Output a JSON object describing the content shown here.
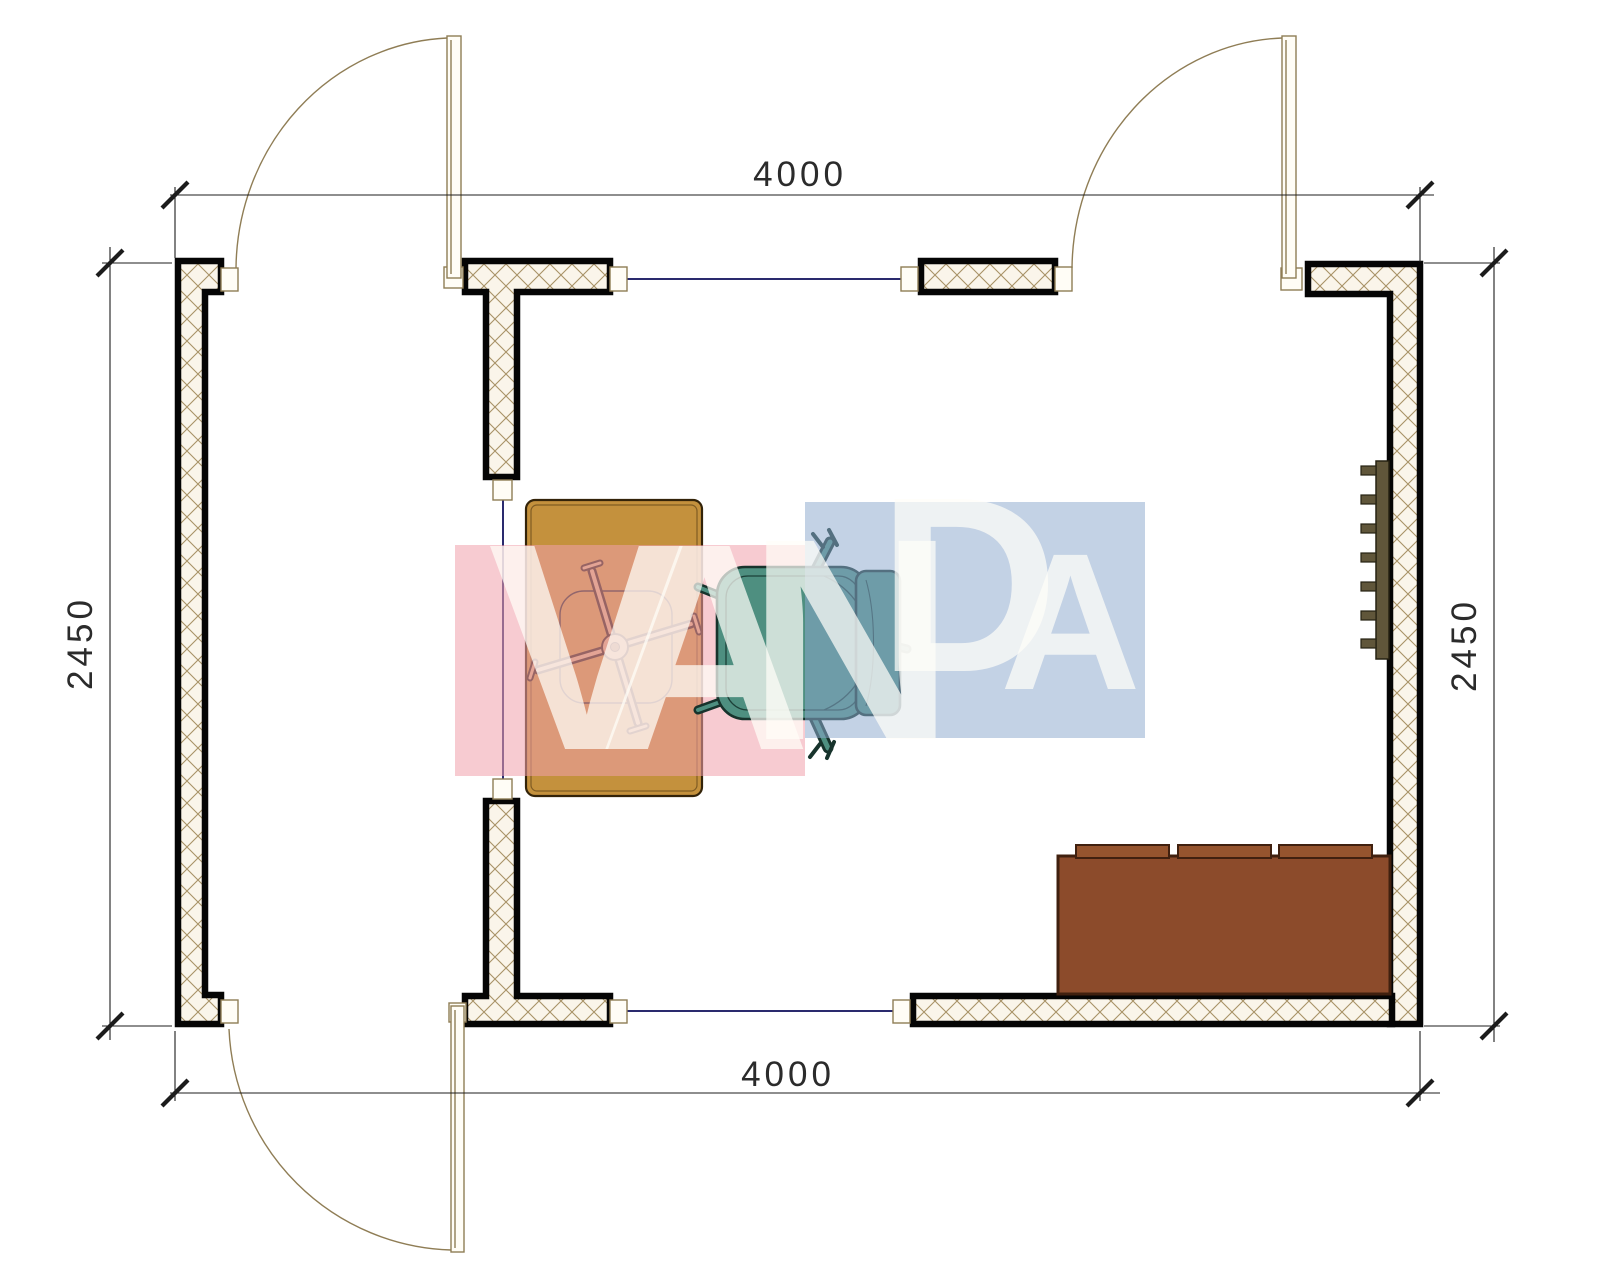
{
  "drawing": {
    "type": "floor-plan",
    "title": "room plan 4000 x 2450"
  },
  "dimensions": {
    "top": "4000",
    "bottom": "4000",
    "left": "2450",
    "right": "2450"
  },
  "watermark": {
    "text": "VANDA",
    "letters": [
      "V",
      "A",
      "N",
      "D",
      "A"
    ],
    "pink_color": "#F2A0AC",
    "blue_color": "#8CA8CD",
    "letter_color": "#FFFDF8"
  },
  "colors": {
    "wall_outline": "#050505",
    "wall_hatch": "#A89266",
    "wall_fill": "#FAF5EA",
    "door_frame": "#8F7D55",
    "window_line": "#2A2A6E",
    "dimension_line": "#1C1C1C",
    "desk": "#C4913D",
    "office_chair_base": "#D3A87B",
    "armchair": "#4E8F80",
    "sofa": "#8C4B2B",
    "sofa_cushion": "#95542E",
    "shelf": "#60563A"
  }
}
